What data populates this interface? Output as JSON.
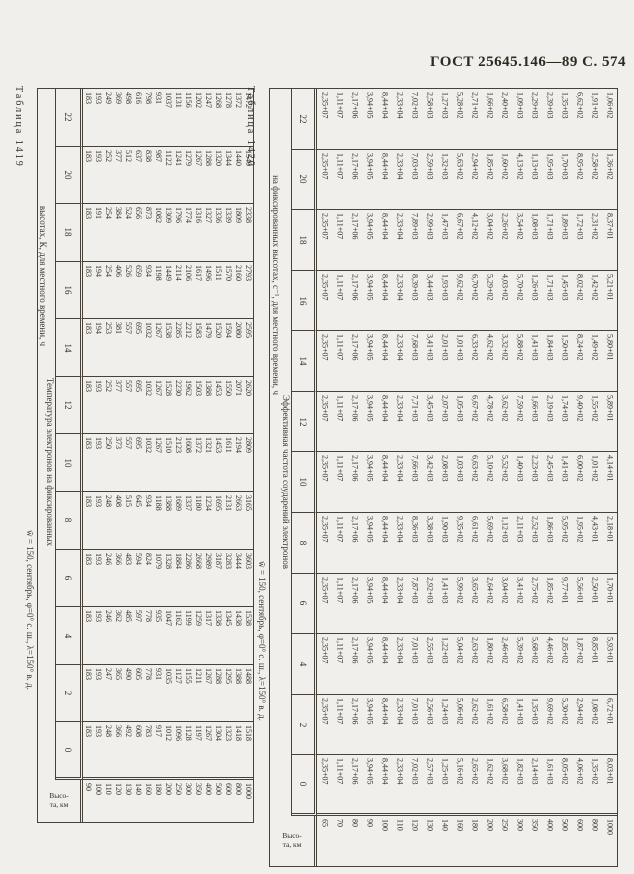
{
  "page": {
    "header": "ГОСТ 25645.146—89 С. 574"
  },
  "tables": [
    {
      "caption": "Таблица 1419",
      "subtitle": "w̄ = 150, сентябрь, φ=0° с. ш., λ=150° в. д.",
      "title_lines": [
        "Температура электронов на фиксированных",
        "высотах, К, для местного времени, ч"
      ],
      "corner_lines": [
        "Высо-",
        "та, км"
      ],
      "heights": [
        "90",
        "100",
        "110",
        "120",
        "130",
        "140",
        "160",
        "180",
        "200",
        "250",
        "300",
        "350",
        "400",
        "500",
        "600",
        "800",
        "1000"
      ],
      "bands": [
        {
          "hour": "22",
          "values": [
            "183",
            "193",
            "249",
            "369",
            "498",
            "616",
            "798",
            "931",
            "1037",
            "1131",
            "1156",
            "1202",
            "1247",
            "1268",
            "1278",
            "1372",
            "1472"
          ]
        },
        {
          "hour": "20",
          "values": [
            "183",
            "193",
            "252",
            "377",
            "512",
            "637",
            "838",
            "987",
            "1122",
            "1241",
            "1279",
            "1267",
            "1288",
            "1320",
            "1344",
            "1440",
            "1540"
          ]
        },
        {
          "hour": "18",
          "values": [
            "183",
            "191",
            "254",
            "384",
            "524",
            "656",
            "873",
            "1082",
            "1309",
            "1796",
            "1774",
            "1316",
            "1327",
            "1336",
            "1339",
            "1809",
            "2338"
          ]
        },
        {
          "hour": "16",
          "values": [
            "183",
            "194",
            "254",
            "406",
            "526",
            "659",
            "934",
            "1198",
            "1449",
            "2114",
            "2106",
            "1617",
            "1496",
            "1511",
            "1570",
            "2160",
            "2793"
          ]
        },
        {
          "hour": "14",
          "values": [
            "183",
            "194",
            "253",
            "381",
            "557",
            "695",
            "1032",
            "1267",
            "1538",
            "2285",
            "2212",
            "1583",
            "1479",
            "1520",
            "1594",
            "2080",
            "2595"
          ]
        },
        {
          "hour": "12",
          "values": [
            "183",
            "193",
            "252",
            "377",
            "557",
            "695",
            "1032",
            "1267",
            "1528",
            "2230",
            "1962",
            "1503",
            "1388",
            "1453",
            "1550",
            "2071",
            "2620"
          ]
        },
        {
          "hour": "10",
          "values": [
            "183",
            "193",
            "250",
            "373",
            "557",
            "695",
            "1032",
            "1267",
            "1510",
            "2123",
            "1608",
            "1372",
            "1321",
            "1453",
            "1611",
            "2194",
            "2809"
          ]
        },
        {
          "hour": "8",
          "values": [
            "183",
            "193",
            "248",
            "408",
            "515",
            "645",
            "934",
            "1188",
            "1388",
            "1689",
            "1337",
            "1180",
            "1234",
            "1695",
            "2131",
            "2663",
            "3165"
          ]
        },
        {
          "hour": "6",
          "values": [
            "183",
            "193",
            "246",
            "366",
            "483",
            "594",
            "824",
            "1079",
            "1328",
            "1884",
            "2286",
            "2668",
            "2989",
            "3187",
            "3283",
            "3444",
            "3603"
          ]
        },
        {
          "hour": "4",
          "values": [
            "183",
            "193",
            "246",
            "362",
            "485",
            "597",
            "778",
            "935",
            "1047",
            "1162",
            "1199",
            "1259",
            "1317",
            "1338",
            "1345",
            "1438",
            "1538"
          ]
        },
        {
          "hour": "2",
          "values": [
            "183",
            "193",
            "247",
            "365",
            "490",
            "605",
            "778",
            "931",
            "1035",
            "1127",
            "1155",
            "1211",
            "1267",
            "1288",
            "1295",
            "1388",
            "1488"
          ]
        },
        {
          "hour": "0",
          "values": [
            "183",
            "193",
            "248",
            "366",
            "492",
            "608",
            "783",
            "917",
            "1012",
            "1096",
            "1128",
            "1197",
            "1267",
            "1304",
            "1323",
            "1418",
            "1518"
          ]
        }
      ]
    },
    {
      "caption": "Таблица 1420",
      "subtitle": "w̄ = 150, сентябрь, φ=0° с. ш., λ=150° в. д.",
      "title_lines": [
        "Эффективная частота соударений электронов",
        "на фиксированных высотах, с⁻¹, для местного времени, ч"
      ],
      "corner_lines": [
        "Высо-",
        "та, км"
      ],
      "heights": [
        "65",
        "70",
        "80",
        "90",
        "100",
        "110",
        "120",
        "130",
        "140",
        "160",
        "180",
        "200",
        "250",
        "300",
        "350",
        "400",
        "500",
        "600",
        "800",
        "1000"
      ],
      "bands": [
        {
          "hour": "22",
          "values": [
            "2,35+07",
            "1,11+07",
            "2,17+06",
            "3,94+05",
            "8,44+04",
            "2,33+04",
            "7,02+03",
            "2,58+03",
            "1,27+03",
            "5,28+02",
            "2,71+02",
            "1,66+02",
            "2,40+02",
            "1,09+03",
            "2,29+03",
            "2,39+03",
            "1,35+03",
            "6,62+02",
            "1,91+02",
            "1,06+02"
          ]
        },
        {
          "hour": "20",
          "values": [
            "2,35+07",
            "1,11+07",
            "2,17+06",
            "3,94+05",
            "8,44+04",
            "2,33+04",
            "7,03+03",
            "2,59+03",
            "1,32+03",
            "5,63+02",
            "2,94+02",
            "1,85+02",
            "1,60+02",
            "4,13+02",
            "1,13+03",
            "1,95+03",
            "1,70+03",
            "8,95+02",
            "2,58+02",
            "1,36+02"
          ]
        },
        {
          "hour": "18",
          "values": [
            "2,35+07",
            "1,11+07",
            "2,17+06",
            "3,94+05",
            "8,44+04",
            "2,33+04",
            "7,89+03",
            "2,99+03",
            "1,47+03",
            "6,67+02",
            "4,12+02",
            "3,04+02",
            "2,26+02",
            "3,54+02",
            "1,08+03",
            "1,71+03",
            "1,89+03",
            "1,72+03",
            "2,31+02",
            "8,37+01"
          ]
        },
        {
          "hour": "16",
          "values": [
            "2,35+07",
            "1,11+07",
            "2,17+06",
            "3,94+05",
            "8,44+04",
            "2,33+04",
            "8,39+03",
            "3,44+03",
            "1,93+03",
            "9,62+02",
            "6,70+02",
            "5,29+02",
            "4,03+02",
            "5,70+02",
            "1,26+03",
            "1,71+03",
            "1,45+03",
            "8,02+02",
            "1,42+02",
            "5,21+01"
          ]
        },
        {
          "hour": "14",
          "values": [
            "2,35+07",
            "1,11+07",
            "2,17+06",
            "3,94+05",
            "8,44+04",
            "2,33+04",
            "7,68+03",
            "3,41+03",
            "2,01+03",
            "1,01+03",
            "6,33+02",
            "4,62+02",
            "3,32+02",
            "5,88+02",
            "1,41+03",
            "1,84+03",
            "1,50+03",
            "8,24+02",
            "1,49+02",
            "5,80+01"
          ]
        },
        {
          "hour": "12",
          "values": [
            "2,35+07",
            "1,11+07",
            "2,17+06",
            "3,94+05",
            "8,44+04",
            "2,33+04",
            "7,71+03",
            "3,45+03",
            "2,07+03",
            "1,05+03",
            "6,67+02",
            "4,78+02",
            "3,62+02",
            "7,59+02",
            "1,66+03",
            "2,19+03",
            "1,74+03",
            "9,40+02",
            "1,55+02",
            "5,89+01"
          ]
        },
        {
          "hour": "10",
          "values": [
            "2,35+07",
            "1,11+07",
            "2,17+06",
            "3,94+05",
            "8,44+04",
            "2,33+04",
            "7,66+03",
            "3,42+03",
            "2,08+03",
            "1,03+03",
            "6,63+02",
            "5,10+02",
            "5,52+02",
            "1,40+03",
            "2,23+03",
            "2,45+03",
            "1,41+03",
            "6,00+02",
            "1,01+02",
            "4,14+01"
          ]
        },
        {
          "hour": "8",
          "values": [
            "2,35+07",
            "1,11+07",
            "2,17+06",
            "3,94+05",
            "8,44+04",
            "2,33+04",
            "8,36+03",
            "3,38+03",
            "1,90+03",
            "9,35+02",
            "6,61+02",
            "5,69+02",
            "1,12+03",
            "2,11+03",
            "2,52+03",
            "1,86+03",
            "5,95+02",
            "1,95+02",
            "4,43+01",
            "2,18+01"
          ]
        },
        {
          "hour": "6",
          "values": [
            "2,35+07",
            "1,11+07",
            "2,17+06",
            "3,94+05",
            "8,44+04",
            "2,33+04",
            "7,87+03",
            "2,92+03",
            "1,41+03",
            "5,99+02",
            "3,65+02",
            "2,64+02",
            "3,04+02",
            "3,41+02",
            "2,75+02",
            "1,85+02",
            "9,77+01",
            "5,56+01",
            "2,50+01",
            "1,70+01"
          ]
        },
        {
          "hour": "4",
          "values": [
            "2,35+07",
            "1,11+07",
            "2,17+06",
            "3,94+05",
            "8,44+04",
            "2,33+04",
            "7,01+03",
            "2,55+03",
            "1,22+03",
            "5,04+02",
            "2,63+02",
            "1,80+02",
            "2,46+02",
            "5,39+02",
            "5,68+02",
            "4,46+02",
            "2,85+02",
            "1,87+02",
            "8,85+01",
            "5,93+01"
          ]
        },
        {
          "hour": "2",
          "values": [
            "2,35+07",
            "1,11+07",
            "2,17+06",
            "3,94+05",
            "8,44+04",
            "2,33+04",
            "7,01+03",
            "2,56+03",
            "1,24+03",
            "5,06+02",
            "2,62+02",
            "1,61+02",
            "6,58+02",
            "1,41+03",
            "1,35+03",
            "9,69+02",
            "5,30+02",
            "2,94+02",
            "1,08+02",
            "6,72+01"
          ]
        },
        {
          "hour": "0",
          "values": [
            "2,35+07",
            "1,11+07",
            "2,17+06",
            "3,94+05",
            "8,44+04",
            "2,33+04",
            "7,02+03",
            "2,57+03",
            "1,25+03",
            "5,16+02",
            "2,65+02",
            "1,62+02",
            "3,68+02",
            "1,82+03",
            "2,14+03",
            "1,61+03",
            "8,05+02",
            "4,06+02",
            "1,35+02",
            "8,03+01"
          ]
        }
      ]
    }
  ]
}
